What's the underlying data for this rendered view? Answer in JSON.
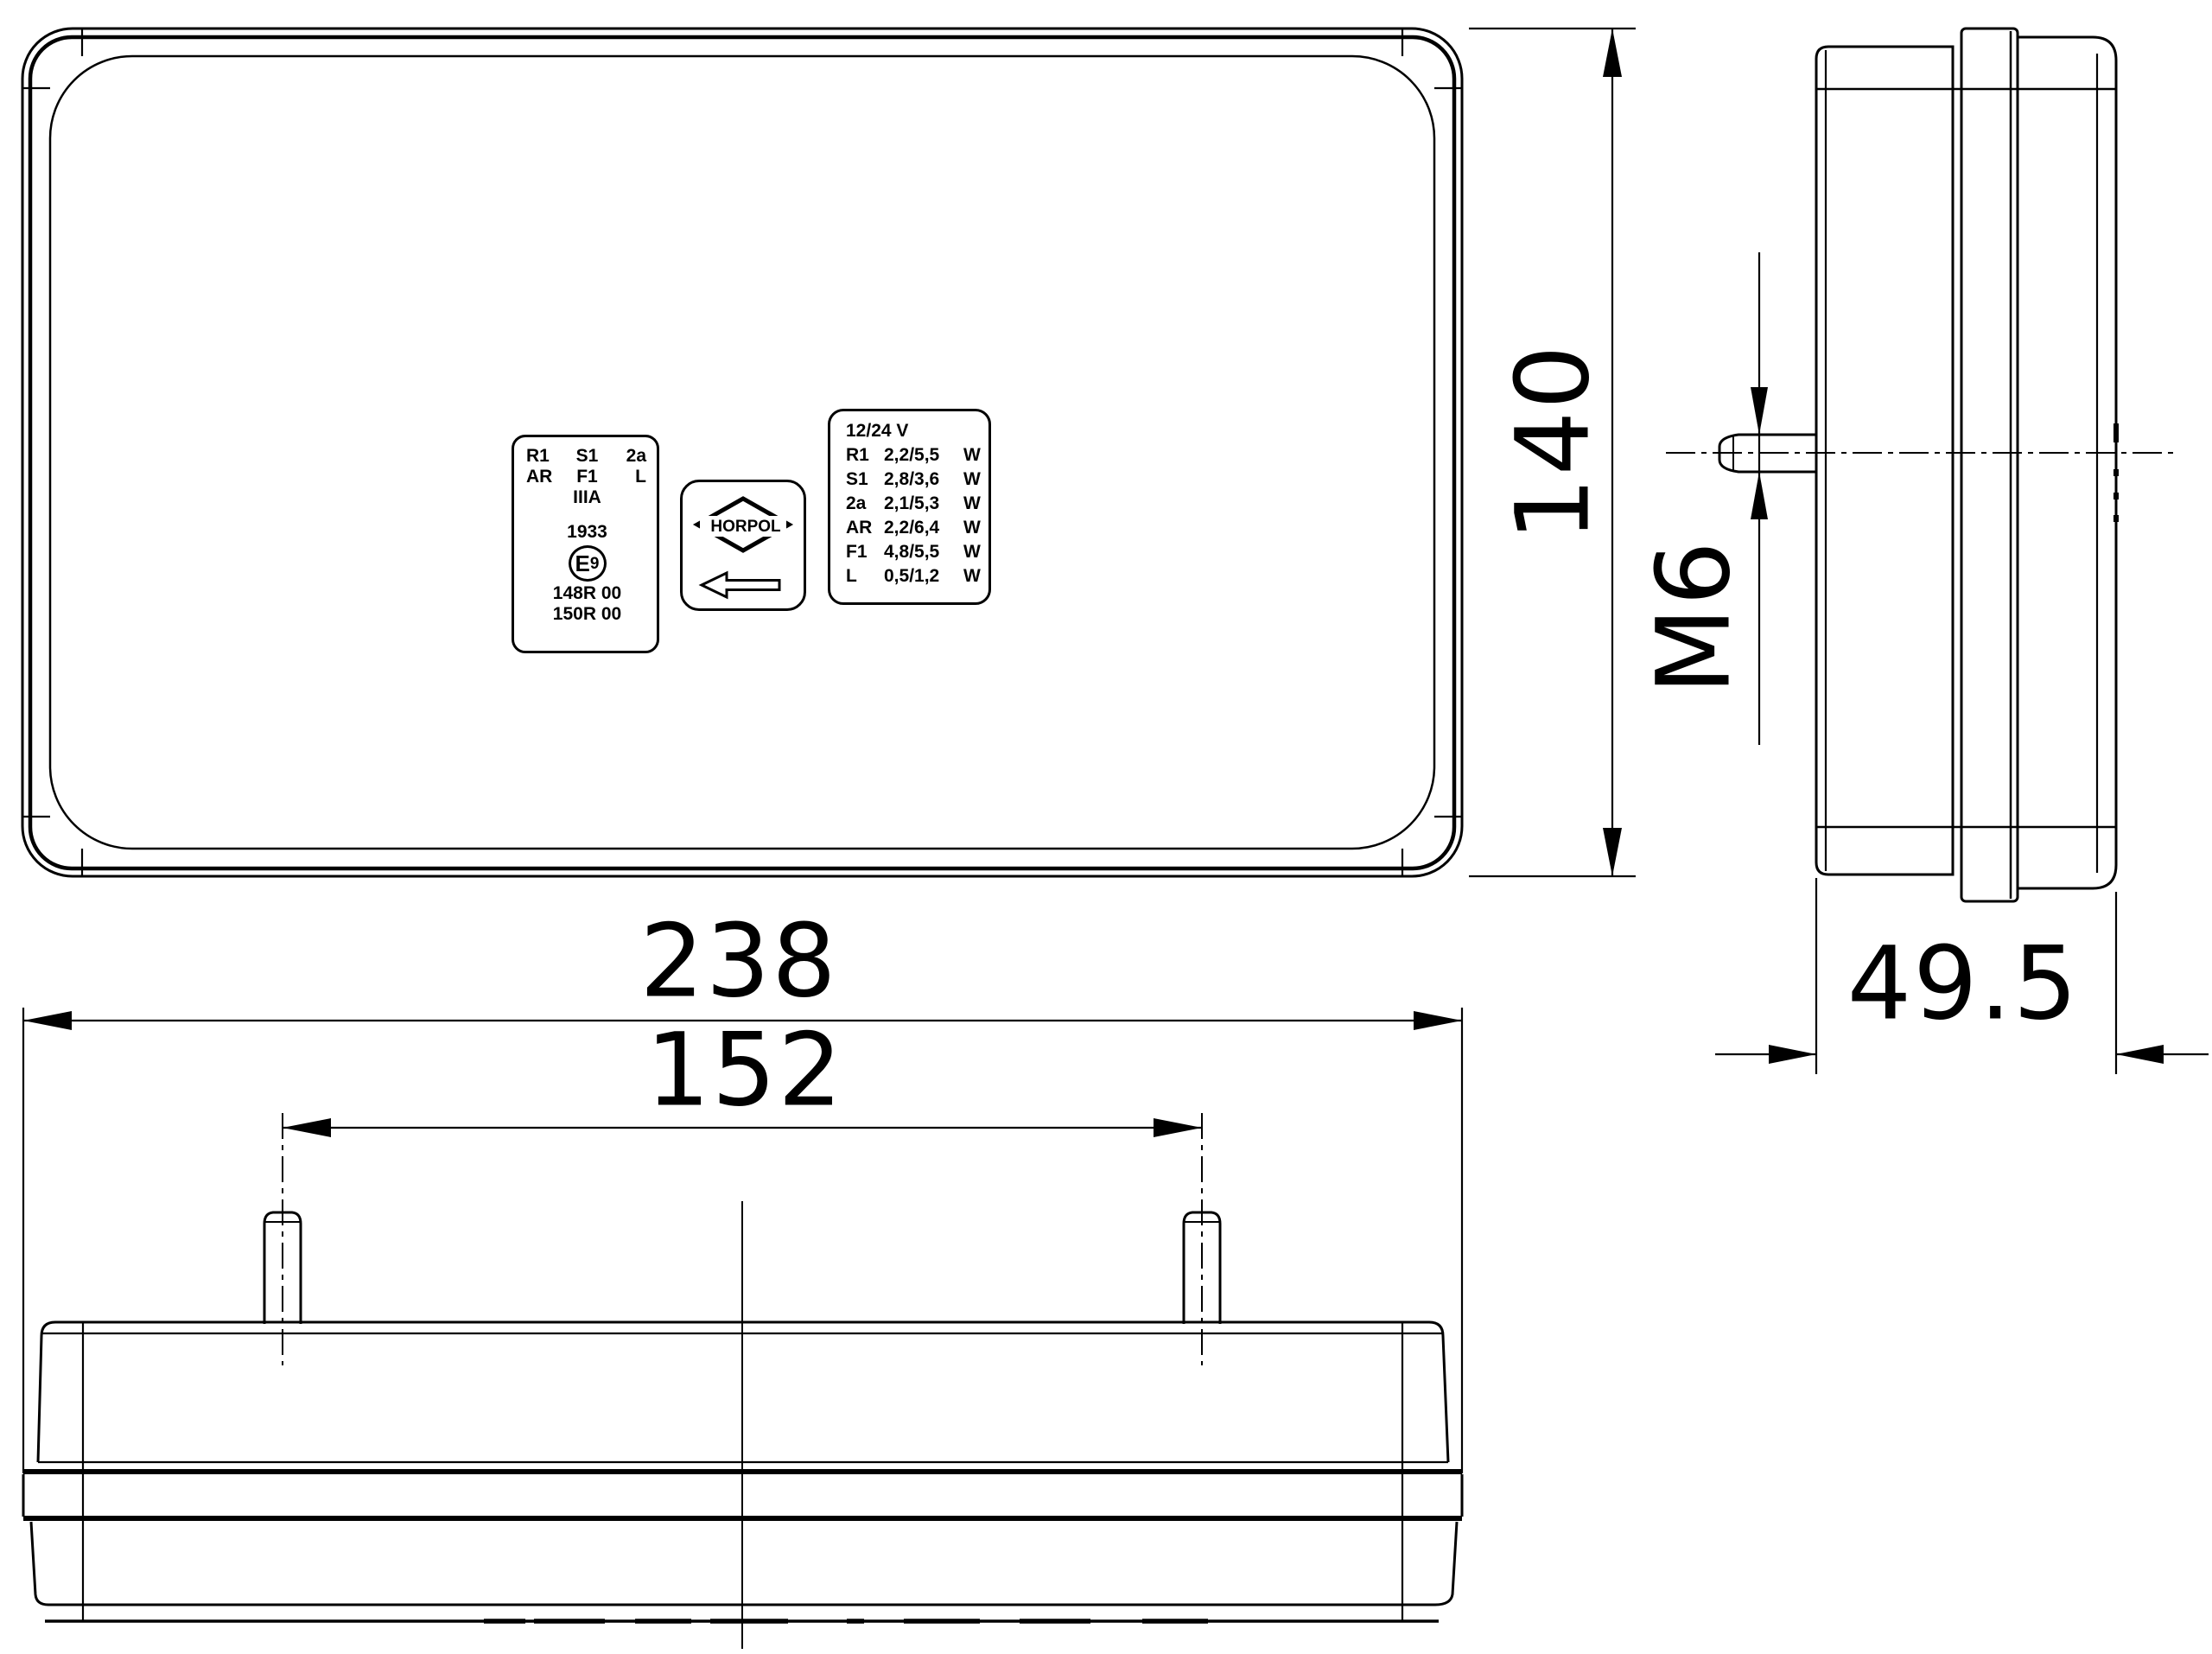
{
  "drawing": {
    "dims": {
      "overall_width": "238",
      "stud_spacing": "152",
      "overall_height": "140",
      "overall_depth": "49.5",
      "stud_thread": "M6"
    },
    "approval_label": {
      "row1": [
        "R1",
        "S1",
        "2a"
      ],
      "row2": [
        "AR",
        "F1",
        "L"
      ],
      "category": "IIIA",
      "approval_number": "1933",
      "e_mark_letter": "E",
      "e_mark_digit": "9",
      "codes": [
        "148R 00",
        "150R 00"
      ]
    },
    "brand_label": {
      "name": "HORPOL"
    },
    "spec_label": {
      "voltage": "12/24 V",
      "unit": "W",
      "rows": [
        [
          "R1",
          "2,2/5,5"
        ],
        [
          "S1",
          "2,8/3,6"
        ],
        [
          "2a",
          "2,1/5,3"
        ],
        [
          "AR",
          "2,2/6,4"
        ],
        [
          "F1",
          "4,8/5,5"
        ],
        [
          "L",
          "0,5/1,2"
        ]
      ]
    }
  }
}
